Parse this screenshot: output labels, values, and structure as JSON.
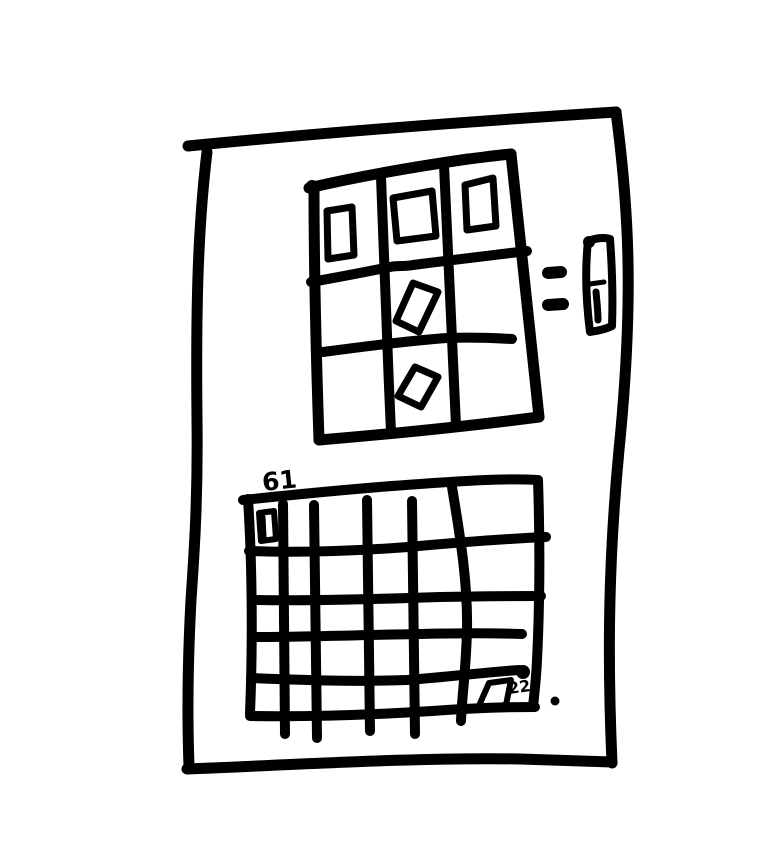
{
  "canvas": {
    "background_color": "#ffffff",
    "ink_color": "#000000"
  },
  "sketch": {
    "photo_grid": {
      "rows": 3,
      "columns": 3,
      "photo_placeholders": 5
    },
    "side_controls": {
      "dash_count": 2
    },
    "calendar_grid": {
      "columns": 6,
      "rows": 5,
      "corner_label": "61",
      "event_label": "22"
    }
  }
}
